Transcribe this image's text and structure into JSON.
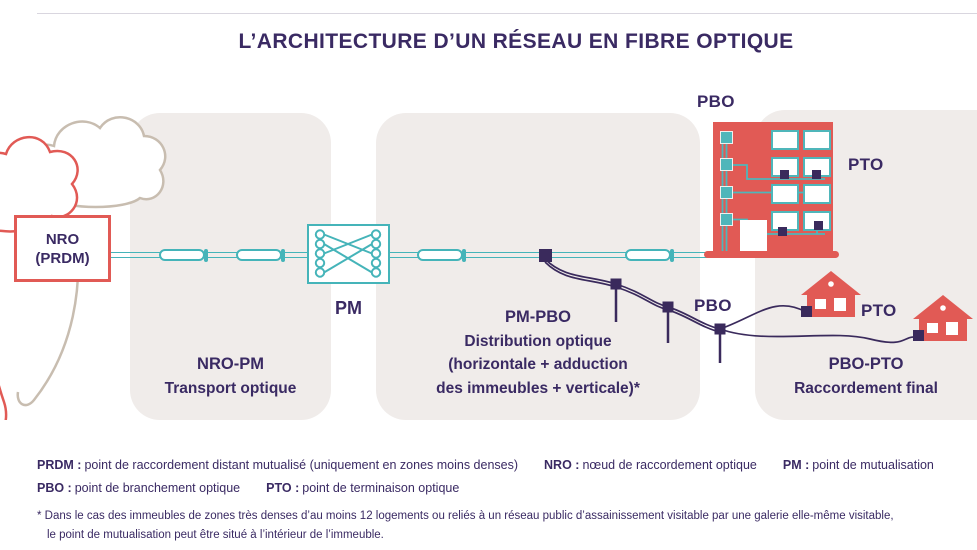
{
  "title": "L’ARCHITECTURE D’UN RÉSEAU EN FIBRE OPTIQUE",
  "colors": {
    "accent_teal": "#45b4b9",
    "accent_red": "#e15a55",
    "ink_purple": "#3a2a63",
    "section_bg": "#f0ecea",
    "cloud_tan": "#c8bdb0"
  },
  "nodes": {
    "nro": {
      "line1": "NRO",
      "line2": "(PRDM)"
    },
    "pm_label": "PM",
    "building_pbo_label": "PBO",
    "building_pto_label": "PTO",
    "aerial_pbo_label": "PBO",
    "house_pto_label": "PTO"
  },
  "sections": [
    {
      "title": "NRO-PM",
      "lines": [
        "Transport optique"
      ]
    },
    {
      "title": "PM-PBO",
      "lines": [
        "Distribution optique",
        "(horizontale + adduction",
        "des immeubles + verticale)*"
      ]
    },
    {
      "title": "PBO-PTO",
      "lines": [
        "Raccordement final"
      ]
    }
  ],
  "legend": {
    "row1": [
      {
        "term": "PRDM :",
        "def": "point de raccordement distant mutualisé (uniquement en zones moins denses)"
      },
      {
        "term": "NRO :",
        "def": "nœud de raccordement optique"
      },
      {
        "term": "PM :",
        "def": "point de mutualisation"
      }
    ],
    "row2": [
      {
        "term": "PBO :",
        "def": "point de branchement optique"
      },
      {
        "term": "PTO :",
        "def": "point de terminaison optique"
      }
    ]
  },
  "footnote": {
    "line1": "* Dans le cas des immeubles de zones très denses d’au moins 12 logements ou reliés à un réseau public d’assainissement visitable par une galerie elle-même visitable,",
    "line2": "le point de mutualisation peut être situé à l’intérieur de l’immeuble."
  }
}
